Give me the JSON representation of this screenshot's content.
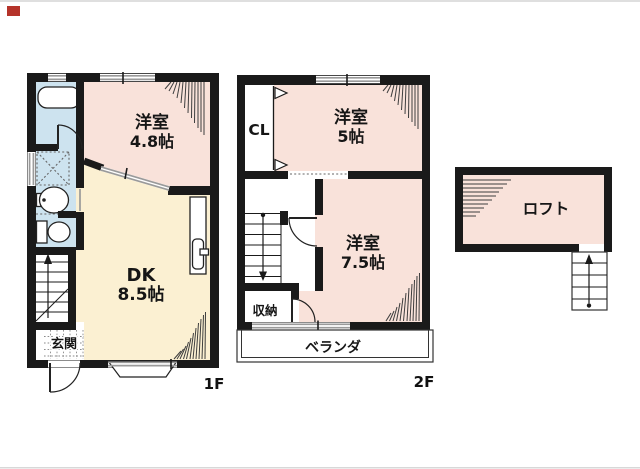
{
  "meta": {
    "kind": "real-estate floor plan",
    "floors_shown": 3
  },
  "floor1": {
    "label": "1F",
    "western_room": {
      "name": "洋室",
      "size": "4.8帖"
    },
    "dining_kitchen": {
      "name": "DK",
      "size": "8.5帖"
    },
    "entrance": {
      "name": "玄関"
    }
  },
  "floor2": {
    "label": "2F",
    "closet": {
      "name": "CL"
    },
    "western_room_5": {
      "name": "洋室",
      "size": "5帖"
    },
    "western_room_75": {
      "name": "洋室",
      "size": "7.5帖"
    },
    "storage": {
      "name": "収納"
    },
    "veranda": {
      "name": "ベランダ"
    }
  },
  "loft": {
    "name": "ロフト"
  },
  "colors": {
    "room_pink": "#f9e2da",
    "dk_cream": "#fbf0d2",
    "wet_area_blue": "#cde3ef",
    "wall_black": "#1a1a1a",
    "window_gray": "#9a9a9a",
    "marker_red": "#b5332a"
  }
}
